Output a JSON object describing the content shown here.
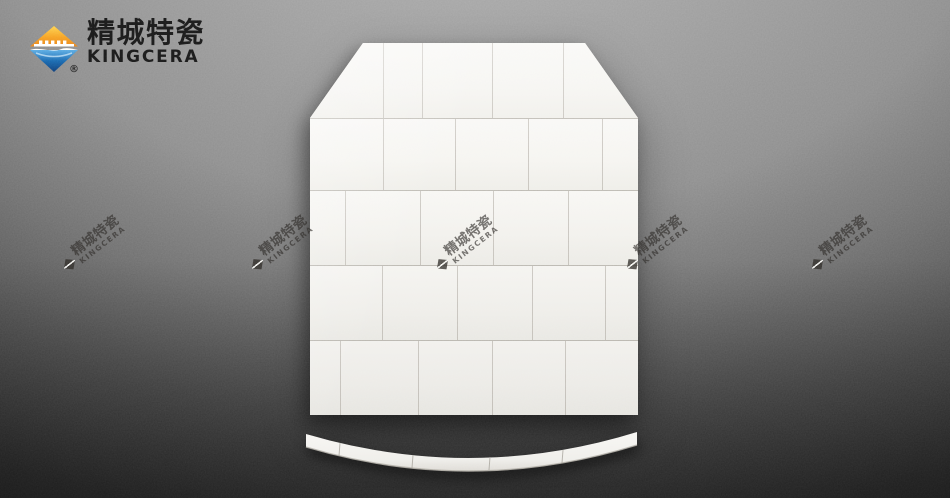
{
  "brand": {
    "name_cn": "精城特瓷",
    "name_en": "KINGCERA",
    "registered_mark": "®",
    "colors": {
      "logo_orange_light": "#ffd24a",
      "logo_orange_deep": "#e8821a",
      "logo_blue_light": "#57aae3",
      "logo_blue_deep": "#0c3a78",
      "text_black": "#151515"
    }
  },
  "watermark": {
    "text_cn": "精城特瓷",
    "text_en": "KINGCERA",
    "rotation_deg": -38,
    "positions": [
      {
        "x": 100,
        "y": 247
      },
      {
        "x": 288,
        "y": 247
      },
      {
        "x": 473,
        "y": 247
      },
      {
        "x": 663,
        "y": 247
      },
      {
        "x": 848,
        "y": 247
      }
    ]
  },
  "scene": {
    "background_light": "#9e9e9e",
    "background_dark": "#0c0c0c",
    "tile_color": "#f6f5f1",
    "seam_color": "#968f84",
    "plate_rows": [
      {
        "height": 75,
        "tiles": [
          73,
          39,
          70,
          71,
          75
        ]
      },
      {
        "height": 72,
        "tiles": [
          73,
          72,
          73,
          74,
          36
        ]
      },
      {
        "height": 75,
        "tiles": [
          35,
          75,
          73,
          75,
          70
        ]
      },
      {
        "height": 75,
        "tiles": [
          72,
          75,
          75,
          73,
          33
        ]
      },
      {
        "height": 75,
        "tiles": [
          30,
          78,
          74,
          73,
          73
        ]
      }
    ],
    "strip_seams": [
      {
        "x": 44,
        "y": 23
      },
      {
        "x": 117,
        "y": 35
      },
      {
        "x": 194,
        "y": 37
      },
      {
        "x": 267,
        "y": 30
      }
    ]
  }
}
